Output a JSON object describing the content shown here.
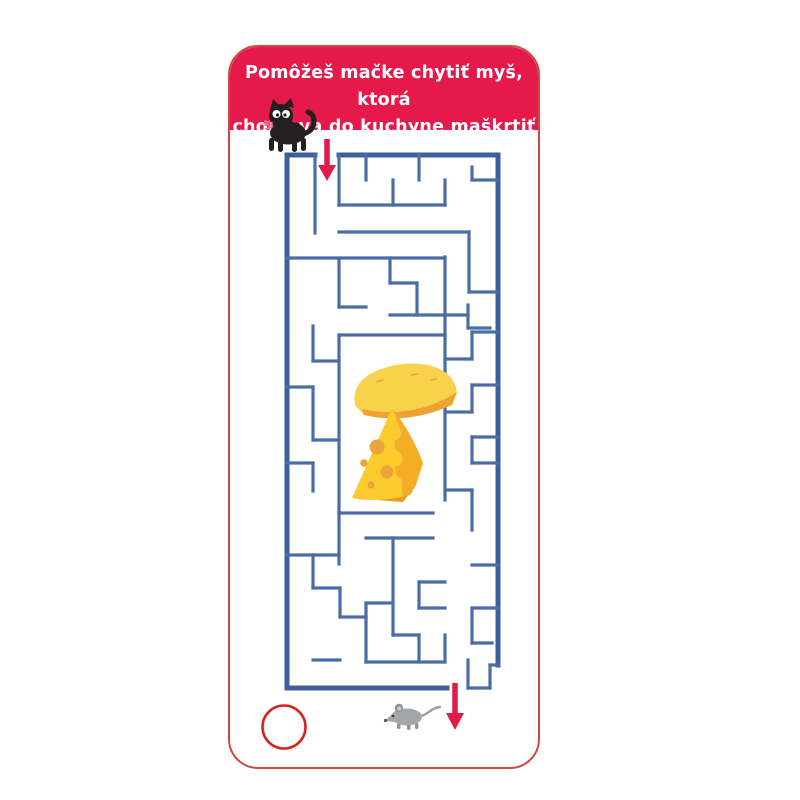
{
  "page": {
    "background": "#ffffff"
  },
  "card": {
    "border_color": "#cd4a43",
    "background": "#ffffff"
  },
  "header": {
    "background_color": "#e6194b",
    "text_color": "#ffffff",
    "title_line1": "Pomôžeš mačke chytiť myš, ktorá",
    "title_line2": "chodieva do kuchyne maškrtiť syr?"
  },
  "maze": {
    "width": 211,
    "height": 533,
    "wall_color": "#4a6da6",
    "outer_wall_color": "#3d5f9e",
    "entrance": {
      "side": "top",
      "x": 40
    },
    "exit": {
      "side": "bottom",
      "x": 170
    },
    "outer_walls": [
      [
        0,
        0,
        28,
        0
      ],
      [
        52,
        0,
        211,
        0
      ],
      [
        0,
        0,
        0,
        533
      ],
      [
        211,
        0,
        211,
        510
      ],
      [
        0,
        533,
        160,
        533
      ]
    ],
    "inner_walls": [
      [
        185,
        25,
        211,
        25
      ],
      [
        52,
        50,
        158,
        50
      ],
      [
        52,
        77,
        182,
        77
      ],
      [
        0,
        103,
        158,
        103
      ],
      [
        103,
        128,
        130,
        128
      ],
      [
        182,
        137,
        211,
        137
      ],
      [
        52,
        152,
        79,
        152
      ],
      [
        103,
        160,
        181,
        160
      ],
      [
        181,
        173,
        203,
        173
      ],
      [
        52,
        180,
        158,
        180
      ],
      [
        26,
        206,
        52,
        206
      ],
      [
        0,
        232,
        26,
        232
      ],
      [
        26,
        285,
        52,
        285
      ],
      [
        185,
        177,
        211,
        177
      ],
      [
        158,
        204,
        185,
        204
      ],
      [
        185,
        230,
        211,
        230
      ],
      [
        158,
        257,
        185,
        257
      ],
      [
        185,
        282,
        211,
        282
      ],
      [
        185,
        308,
        211,
        308
      ],
      [
        158,
        335,
        185,
        335
      ],
      [
        0,
        308,
        26,
        308
      ],
      [
        52,
        358,
        146,
        358
      ],
      [
        79,
        383,
        146,
        383
      ],
      [
        0,
        400,
        52,
        400
      ],
      [
        26,
        433,
        53,
        433
      ],
      [
        132,
        427,
        158,
        427
      ],
      [
        185,
        410,
        211,
        410
      ],
      [
        79,
        448,
        106,
        448
      ],
      [
        53,
        462,
        79,
        462
      ],
      [
        132,
        453,
        158,
        453
      ],
      [
        185,
        453,
        211,
        453
      ],
      [
        106,
        480,
        132,
        480
      ],
      [
        185,
        488,
        205,
        488
      ],
      [
        26,
        505,
        53,
        505
      ],
      [
        79,
        507,
        158,
        507
      ],
      [
        203,
        510,
        211,
        510
      ],
      [
        181,
        533,
        203,
        533
      ],
      [
        28,
        0,
        28,
        78
      ],
      [
        52,
        0,
        52,
        50
      ],
      [
        79,
        0,
        79,
        25
      ],
      [
        106,
        25,
        106,
        50
      ],
      [
        132,
        0,
        132,
        25
      ],
      [
        158,
        25,
        158,
        50
      ],
      [
        185,
        12,
        185,
        25
      ],
      [
        182,
        77,
        182,
        137
      ],
      [
        52,
        104,
        52,
        152
      ],
      [
        103,
        103,
        103,
        128
      ],
      [
        130,
        128,
        130,
        160
      ],
      [
        181,
        150,
        181,
        173
      ],
      [
        26,
        171,
        26,
        206
      ],
      [
        52,
        180,
        52,
        409
      ],
      [
        158,
        102,
        158,
        345
      ],
      [
        26,
        232,
        26,
        285
      ],
      [
        26,
        308,
        26,
        336
      ],
      [
        185,
        177,
        185,
        204
      ],
      [
        185,
        230,
        185,
        257
      ],
      [
        185,
        282,
        185,
        308
      ],
      [
        185,
        335,
        185,
        375
      ],
      [
        26,
        400,
        26,
        433
      ],
      [
        53,
        433,
        53,
        462
      ],
      [
        106,
        383,
        106,
        480
      ],
      [
        79,
        448,
        79,
        507
      ],
      [
        132,
        480,
        132,
        507
      ],
      [
        158,
        480,
        158,
        507
      ],
      [
        132,
        427,
        132,
        453
      ],
      [
        185,
        453,
        185,
        488
      ],
      [
        203,
        510,
        203,
        533
      ],
      [
        181,
        505,
        181,
        533
      ]
    ]
  },
  "markers": {
    "arrow_color": "#e11b48",
    "answer_circle_color": "#d6251f"
  },
  "characters": {
    "cat_color": "#232021",
    "mouse_color": "#a3a7aa",
    "cheese_body_color": "#fccb2e",
    "cheese_wheel_color": "#f8d24b",
    "cheese_side_color": "#f5ad26",
    "cheese_hole_color": "#eda53a"
  }
}
